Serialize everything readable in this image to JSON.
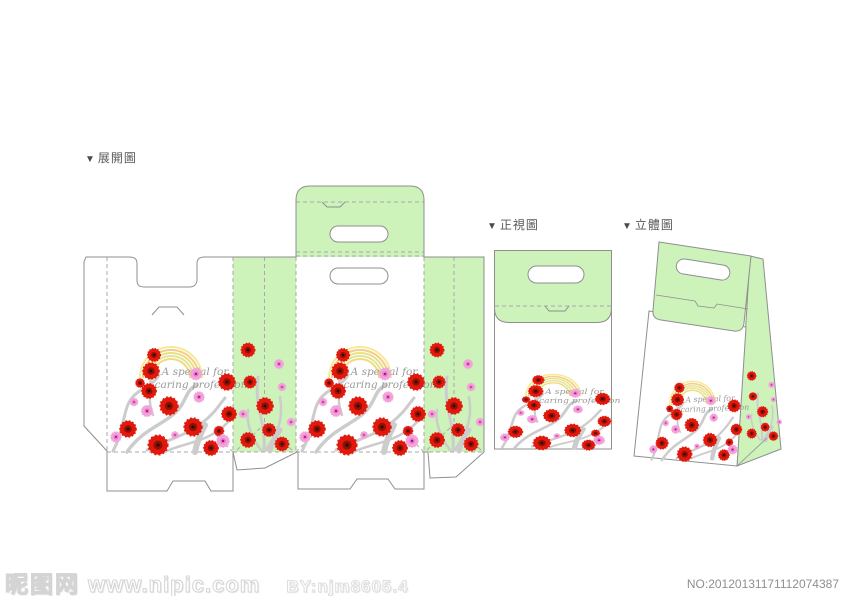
{
  "labels": {
    "bullet": "▼",
    "unfold": "展開圖",
    "front_view": "正視圖",
    "perspective": "立體圖"
  },
  "design": {
    "slogan_line1": "A special for",
    "slogan_line2": "caring profession"
  },
  "watermark": {
    "site_name": "昵图网",
    "site_url": "www.nipic.com",
    "author": "BY:njm8605.4",
    "serial": "NO:20120131171112074387"
  },
  "colors": {
    "green": "#cdf2ba",
    "cut_line": "#8f8f8f",
    "fold_line": "#aaaaaa",
    "red": "#e2180c",
    "red_dark": "#8f1206",
    "red_core": "#3c0a02",
    "pink": "#f2a3da",
    "pink_mid": "#e878cb",
    "pink_core": "#a2126e",
    "branch": "#cccccc",
    "slogan": "#9a9a9a",
    "rainbow": [
      "#f7ea93",
      "#f2cd8b",
      "#ece07d",
      "#dbe79e",
      "#f6d97a"
    ]
  }
}
